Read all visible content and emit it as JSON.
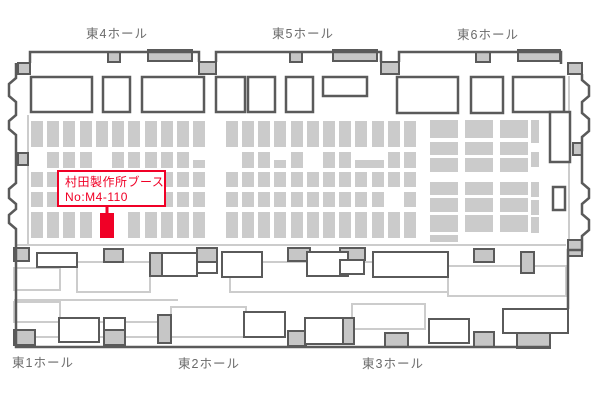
{
  "page": {
    "width": 600,
    "height": 400,
    "background": "#ffffff"
  },
  "colors": {
    "wall": "#5a5a5a",
    "booth_gray": "#cbcbcb",
    "door_gray": "#c6c6c6",
    "light_gray": "#cccccc",
    "hall_label": "#6a6a6a",
    "highlight_red": "#f00026",
    "white": "#ffffff"
  },
  "hall_labels": {
    "top": [
      {
        "id": "east4",
        "text": "東4ホール",
        "x": 117,
        "y": 38
      },
      {
        "id": "east5",
        "text": "東5ホール",
        "x": 303,
        "y": 38
      },
      {
        "id": "east6",
        "text": "東6ホール",
        "x": 488,
        "y": 39
      }
    ],
    "bottom": [
      {
        "id": "east1",
        "text": "東1ホール",
        "x": 43,
        "y": 367
      },
      {
        "id": "east2",
        "text": "東2ホール",
        "x": 209,
        "y": 368
      },
      {
        "id": "east3",
        "text": "東3ホール",
        "x": 393,
        "y": 368
      }
    ]
  },
  "highlight": {
    "label_line1": "村田製作所ブース",
    "label_line2": "No:M4-110",
    "box": [
      57,
      170,
      109,
      37
    ],
    "booth": [
      100,
      213,
      14,
      25
    ],
    "stem": [
      107,
      204,
      107,
      216
    ]
  },
  "walls": [
    "M30,63 V52 H199 V62",
    "M216,62 V52 H381 V62",
    "M399,62 V52 H561 V64",
    "M16,63 V78 L9,84 V96 L16,102 V115 L9,121 V129 L16,135 V183 L9,189 V198 L16,204 V209 L9,215 V223 L16,229 V347 H550",
    "M582,74 V80 L589,86 V96 L582,102 V113 L589,119 V131 L582,137 V183 L589,189 V198 L582,204 V214 L589,220 V230 L582,236 V250 H568 V309"
  ],
  "light_lines": [
    [
      17,
      245,
      566,
      245
    ],
    [
      569,
      76,
      569,
      245
    ],
    [
      28,
      115,
      28,
      244
    ],
    [
      14,
      300,
      178,
      300
    ],
    [
      14,
      322,
      171,
      322
    ],
    [
      14,
      337,
      283,
      337
    ]
  ],
  "doors": [
    [
      18,
      63,
      12,
      11
    ],
    [
      199,
      62,
      17,
      12
    ],
    [
      381,
      62,
      18,
      12
    ],
    [
      568,
      63,
      14,
      11
    ],
    [
      18,
      153,
      10,
      12
    ],
    [
      573,
      143,
      9,
      12
    ],
    [
      568,
      240,
      14,
      16
    ]
  ],
  "wall_bars": [
    [
      108,
      52,
      12,
      10
    ],
    [
      148,
      50,
      44,
      11
    ],
    [
      290,
      52,
      12,
      10
    ],
    [
      333,
      50,
      44,
      11
    ],
    [
      476,
      52,
      14,
      10
    ],
    [
      518,
      50,
      42,
      11
    ]
  ],
  "top_rooms": [
    [
      31,
      77,
      61,
      35
    ],
    [
      103,
      77,
      27,
      35
    ],
    [
      142,
      77,
      62,
      35
    ],
    [
      216,
      77,
      29,
      35
    ],
    [
      248,
      77,
      27,
      35
    ],
    [
      286,
      77,
      27,
      35
    ],
    [
      323,
      77,
      44,
      19
    ],
    [
      397,
      77,
      61,
      36
    ],
    [
      471,
      77,
      32,
      36
    ],
    [
      513,
      77,
      51,
      35
    ]
  ],
  "right_rooms": [
    [
      550,
      112,
      20,
      50
    ],
    [
      553,
      187,
      12,
      23
    ]
  ],
  "grid": {
    "cols": [
      31,
      47,
      63,
      80,
      96,
      112,
      128,
      145,
      161,
      177,
      193,
      226,
      242,
      258,
      274,
      291,
      307,
      323,
      339,
      355,
      372,
      388,
      404
    ],
    "col_w": 12,
    "rows": [
      [
        121,
        26
      ],
      [
        152,
        16
      ],
      [
        172,
        15
      ],
      [
        192,
        15
      ],
      [
        212,
        26
      ]
    ],
    "skips": {
      "1": [
        31,
        96,
        193,
        226,
        274,
        307,
        355,
        372
      ],
      "3": [
        388
      ],
      "4": [
        96,
        112
      ]
    },
    "extras": [
      [
        193,
        160,
        12,
        8
      ],
      [
        274,
        160,
        12,
        8
      ],
      [
        355,
        160,
        29,
        8
      ],
      [
        388,
        160,
        10,
        6
      ]
    ]
  },
  "hall6_grid": {
    "cols": [
      430,
      465,
      500
    ],
    "col_w": 28,
    "rows": [
      [
        120,
        18
      ],
      [
        142,
        13
      ],
      [
        158,
        14
      ],
      [
        182,
        13
      ],
      [
        198,
        14
      ],
      [
        215,
        17
      ]
    ],
    "strip_x": 531,
    "strip_w": 8,
    "strip_cells": [
      [
        120,
        23
      ],
      [
        152,
        15
      ],
      [
        182,
        15
      ],
      [
        200,
        15
      ],
      [
        217,
        16
      ]
    ],
    "extras": [
      [
        430,
        235,
        28,
        7
      ]
    ]
  },
  "lower": {
    "light_rects": [
      [
        14,
        268,
        46,
        22
      ],
      [
        77,
        262,
        73,
        30
      ],
      [
        230,
        262,
        218,
        30
      ],
      [
        448,
        266,
        118,
        30
      ],
      [
        14,
        302,
        46,
        20
      ],
      [
        171,
        307,
        75,
        30
      ],
      [
        352,
        304,
        73,
        25
      ]
    ],
    "white_rects": [
      [
        37,
        253,
        40,
        14
      ],
      [
        162,
        253,
        35,
        23
      ],
      [
        197,
        262,
        20,
        11
      ],
      [
        222,
        252,
        40,
        25
      ],
      [
        307,
        252,
        41,
        24
      ],
      [
        340,
        260,
        24,
        14
      ],
      [
        373,
        252,
        75,
        25
      ],
      [
        59,
        318,
        40,
        24
      ],
      [
        104,
        318,
        21,
        12
      ],
      [
        244,
        312,
        41,
        25
      ],
      [
        305,
        318,
        38,
        26
      ],
      [
        429,
        319,
        40,
        24
      ],
      [
        503,
        309,
        65,
        24
      ]
    ],
    "gray_rects": [
      [
        14,
        248,
        15,
        13
      ],
      [
        104,
        249,
        19,
        13
      ],
      [
        150,
        253,
        12,
        23
      ],
      [
        197,
        248,
        20,
        14
      ],
      [
        288,
        248,
        22,
        13
      ],
      [
        340,
        248,
        25,
        12
      ],
      [
        474,
        249,
        20,
        13
      ],
      [
        521,
        252,
        13,
        21
      ],
      [
        14,
        330,
        21,
        15
      ],
      [
        104,
        330,
        21,
        15
      ],
      [
        158,
        315,
        13,
        28
      ],
      [
        288,
        331,
        18,
        15
      ],
      [
        343,
        318,
        11,
        26
      ],
      [
        385,
        333,
        23,
        14
      ],
      [
        474,
        332,
        20,
        15
      ],
      [
        517,
        333,
        33,
        15
      ]
    ]
  }
}
